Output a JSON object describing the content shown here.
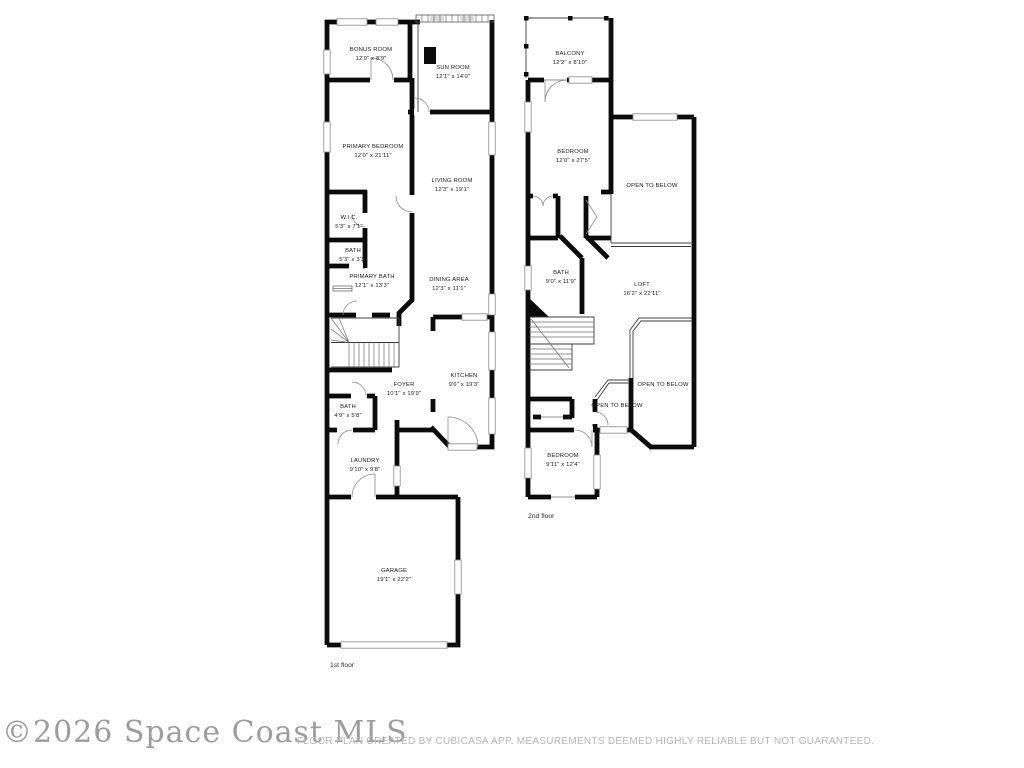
{
  "floor1": {
    "caption": "1st floor",
    "rooms": {
      "bonus": {
        "name": "BONUS ROOM",
        "dims": "12'0\" x 8'9\""
      },
      "sun": {
        "name": "SUN ROOM",
        "dims": "12'1\" x 14'0\""
      },
      "primary_bedroom": {
        "name": "PRIMARY BEDROOM",
        "dims": "12'0\" x 21'11\""
      },
      "living": {
        "name": "LIVING ROOM",
        "dims": "12'3\" x 19'1\""
      },
      "wic": {
        "name": "W.I.C.",
        "dims": "5'3\" x 7'1\""
      },
      "bath": {
        "name": "BATH",
        "dims": "5'3\" x 3'3\""
      },
      "primary_bath": {
        "name": "PRIMARY BATH",
        "dims": "12'1\" x 13'3\""
      },
      "dining": {
        "name": "DINING AREA",
        "dims": "12'3\" x 11'1\""
      },
      "foyer": {
        "name": "FOYER",
        "dims": "10'1\" x 19'9\""
      },
      "kitchen": {
        "name": "KITCHEN",
        "dims": "9'6\" x 19'3\""
      },
      "bath2": {
        "name": "BATH",
        "dims": "4'9\" x 5'8\""
      },
      "laundry": {
        "name": "LAUNDRY",
        "dims": "9'10\" x 9'8\""
      },
      "garage": {
        "name": "GARAGE",
        "dims": "19'1\" x 22'2\""
      }
    }
  },
  "floor2": {
    "caption": "2nd floor",
    "rooms": {
      "balcony": {
        "name": "BALCONY",
        "dims": "12'2\" x 8'10\""
      },
      "bedroom1": {
        "name": "BEDROOM",
        "dims": "12'0\" x 27'5\""
      },
      "bath": {
        "name": "BATH",
        "dims": "9'0\" x 11'9\""
      },
      "loft": {
        "name": "LOFT",
        "dims": "16'2\" x 22'11\""
      },
      "bedroom2": {
        "name": "BEDROOM",
        "dims": "9'11\" x 12'4\""
      },
      "open_below_top": "OPEN TO BELOW",
      "open_below_right": "OPEN TO BELOW",
      "open_below_left": "OPEN TO BELOW"
    }
  },
  "footer": {
    "watermark": "©2026 Space Coast MLS",
    "disclaimer": "FLOOR PLAN CREATED BY CUBICASA APP. MEASUREMENTS DEEMED HIGHLY RELIABLE BUT NOT GUARANTEED."
  }
}
